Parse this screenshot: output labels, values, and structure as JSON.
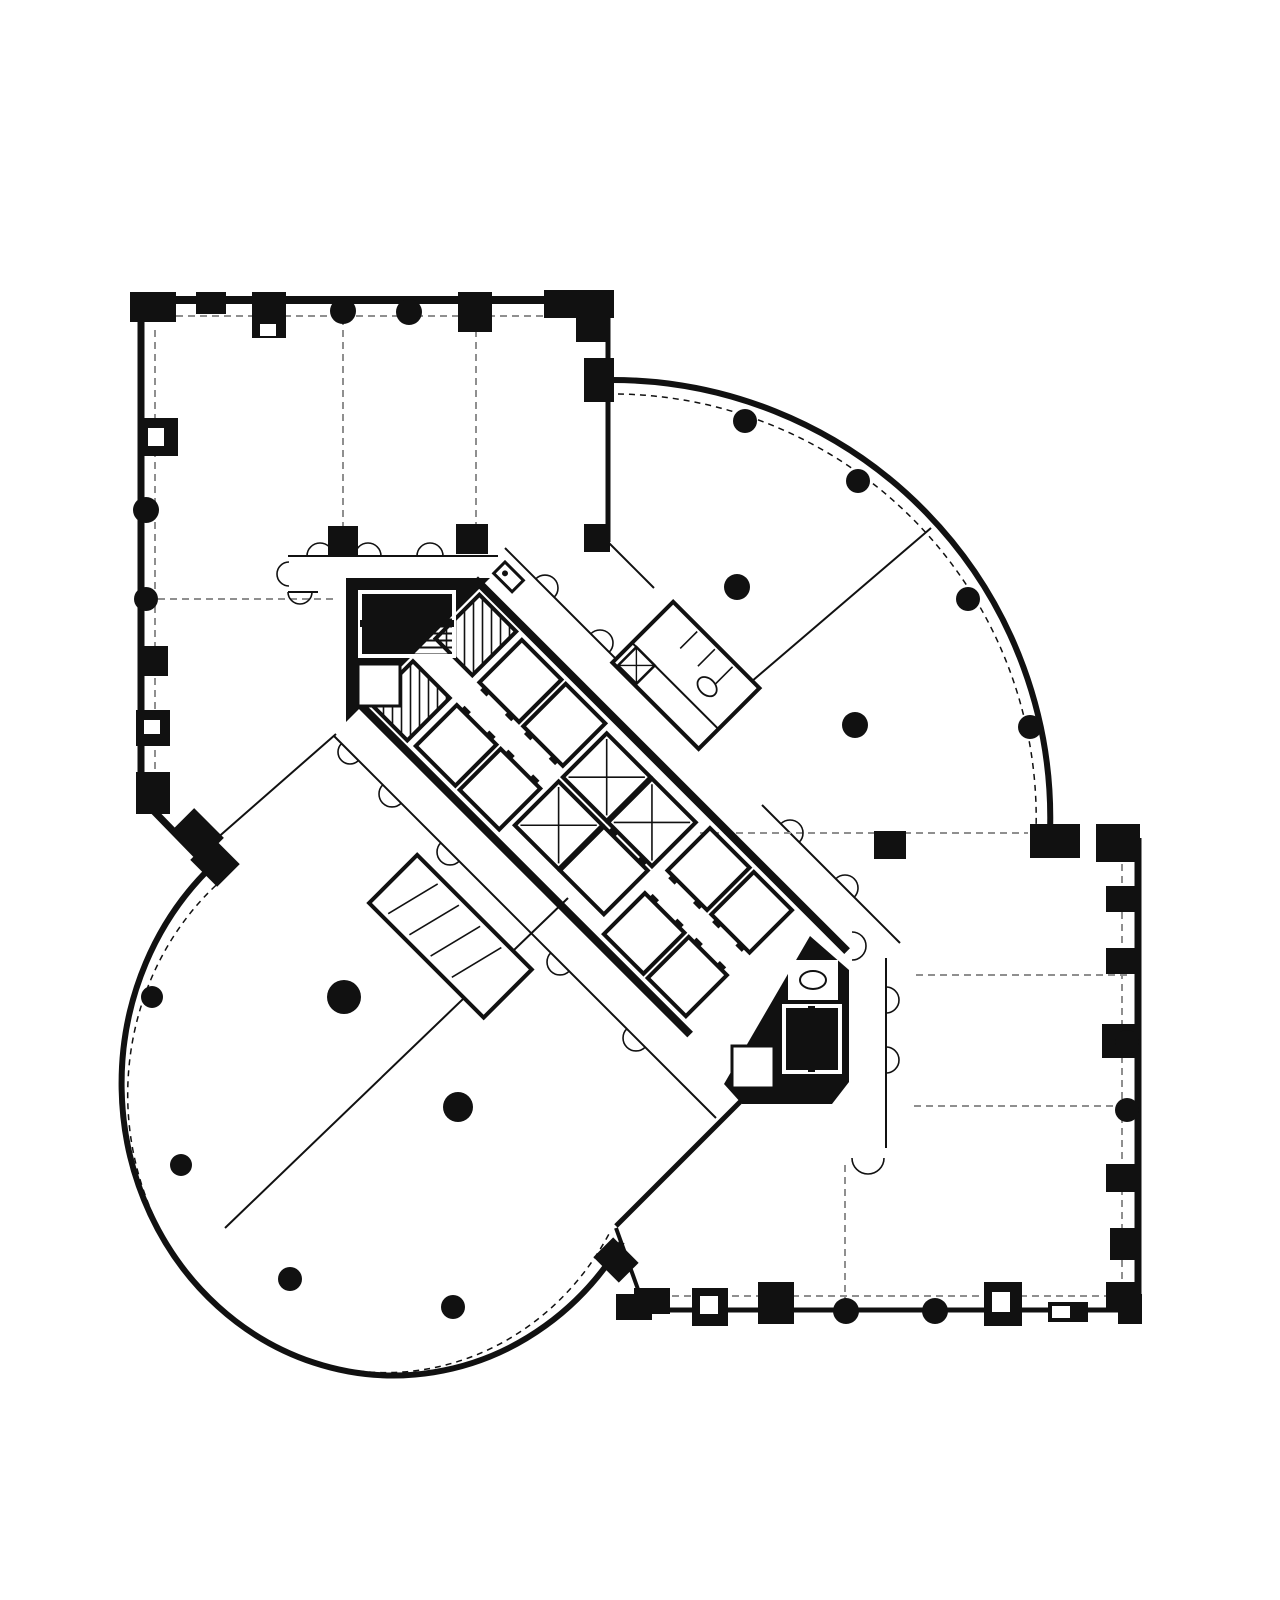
{
  "document": {
    "kind": "scanned architectural floor plan, typical tower floor",
    "visible_text": [],
    "colors": {
      "paper": "#ffffff",
      "ink": "#111111",
      "faint": "#8f8f8f"
    }
  },
  "plan": {
    "regions": [
      "wing-top-left-rectangular",
      "wing-top-right-quarter-round",
      "wing-bottom-left-circular",
      "wing-bottom-right-rectangular",
      "central-diagonal-core"
    ],
    "columns_round": [
      [
        343,
        311,
        13
      ],
      [
        409,
        312,
        13
      ],
      [
        146,
        510,
        13
      ],
      [
        146,
        599,
        12
      ],
      [
        745,
        421,
        12
      ],
      [
        858,
        481,
        12
      ],
      [
        968,
        599,
        12
      ],
      [
        1030,
        727,
        12
      ],
      [
        737,
        587,
        13
      ],
      [
        855,
        725,
        13
      ],
      [
        152,
        997,
        11
      ],
      [
        181,
        1165,
        11
      ],
      [
        290,
        1279,
        12
      ],
      [
        453,
        1307,
        12
      ],
      [
        344,
        997,
        17
      ],
      [
        458,
        1107,
        15
      ],
      [
        1127,
        1042,
        12
      ],
      [
        1127,
        1110,
        12
      ],
      [
        846,
        1311,
        13
      ],
      [
        935,
        1311,
        13
      ]
    ],
    "piers": [
      [
        130,
        292,
        46,
        30,
        0
      ],
      [
        196,
        292,
        30,
        22,
        0
      ],
      [
        252,
        292,
        34,
        46,
        0
      ],
      [
        458,
        292,
        34,
        40,
        0
      ],
      [
        544,
        290,
        70,
        28,
        0
      ],
      [
        576,
        316,
        30,
        26,
        0
      ],
      [
        584,
        358,
        30,
        44,
        0
      ],
      [
        138,
        418,
        40,
        38,
        0
      ],
      [
        138,
        646,
        30,
        30,
        0
      ],
      [
        136,
        710,
        34,
        36,
        0
      ],
      [
        136,
        772,
        34,
        42,
        0
      ],
      [
        176,
        818,
        42,
        34,
        45
      ],
      [
        196,
        846,
        38,
        32,
        45
      ],
      [
        328,
        526,
        30,
        30,
        0
      ],
      [
        456,
        524,
        32,
        30,
        0
      ],
      [
        584,
        524,
        26,
        28,
        0
      ],
      [
        874,
        831,
        32,
        28,
        0
      ],
      [
        1030,
        824,
        50,
        34,
        0
      ],
      [
        1096,
        824,
        44,
        38,
        0
      ],
      [
        1106,
        886,
        32,
        26,
        0
      ],
      [
        1106,
        948,
        32,
        26,
        0
      ],
      [
        1102,
        1024,
        38,
        34,
        0
      ],
      [
        1106,
        1164,
        32,
        28,
        0
      ],
      [
        1110,
        1228,
        30,
        32,
        0
      ],
      [
        1106,
        1282,
        34,
        28,
        0
      ],
      [
        634,
        1288,
        36,
        26,
        0
      ],
      [
        692,
        1288,
        36,
        38,
        0
      ],
      [
        758,
        1282,
        36,
        42,
        0
      ],
      [
        984,
        1282,
        38,
        44,
        0
      ],
      [
        1048,
        1302,
        40,
        20,
        0
      ],
      [
        1118,
        1294,
        24,
        30,
        0
      ],
      [
        598,
        1246,
        36,
        28,
        45
      ],
      [
        616,
        1294,
        36,
        26,
        0
      ]
    ],
    "notches": [
      [
        260,
        324,
        16,
        12
      ],
      [
        148,
        428,
        16,
        18
      ],
      [
        144,
        720,
        16,
        14
      ],
      [
        700,
        1296,
        18,
        18
      ],
      [
        992,
        1292,
        18,
        20
      ],
      [
        1052,
        1306,
        18,
        12
      ]
    ],
    "dashed_partitions": [
      [
        343,
        318,
        343,
        552
      ],
      [
        476,
        318,
        476,
        524
      ],
      [
        158,
        599,
        334,
        599
      ],
      [
        700,
        833,
        1028,
        833
      ],
      [
        916,
        975,
        1128,
        975
      ],
      [
        914,
        1106,
        1128,
        1106
      ],
      [
        845,
        1165,
        845,
        1306
      ],
      [
        152,
        316,
        598,
        316
      ],
      [
        155,
        330,
        155,
        788
      ],
      [
        1122,
        852,
        1122,
        1290
      ],
      [
        660,
        1296,
        1114,
        1296
      ]
    ],
    "thin_partitions": [
      [
        207,
        847,
        336,
        734,
        2
      ],
      [
        568,
        898,
        225,
        1228,
        2
      ],
      [
        931,
        528,
        744,
        688,
        2
      ],
      [
        505,
        548,
        688,
        731,
        2
      ],
      [
        762,
        805,
        900,
        943,
        2
      ],
      [
        334,
        736,
        716,
        1118,
        2
      ],
      [
        886,
        958,
        886,
        1148,
        2
      ],
      [
        288,
        556,
        498,
        556,
        2
      ],
      [
        288,
        592,
        318,
        592,
        2
      ],
      [
        606,
        540,
        654,
        588,
        2
      ],
      [
        616,
        1228,
        644,
        1306,
        4
      ],
      [
        756,
        1086,
        616,
        1226,
        5
      ]
    ],
    "door_arcs": [
      [
        320,
        556,
        13,
        180
      ],
      [
        368,
        556,
        13,
        180
      ],
      [
        430,
        556,
        13,
        180
      ],
      [
        300,
        592,
        12,
        0
      ],
      [
        289,
        574,
        12,
        90
      ],
      [
        545,
        588,
        13,
        225
      ],
      [
        600,
        643,
        13,
        225
      ],
      [
        655,
        698,
        13,
        225
      ],
      [
        790,
        833,
        13,
        225
      ],
      [
        845,
        888,
        13,
        225
      ],
      [
        392,
        794,
        13,
        45
      ],
      [
        450,
        852,
        13,
        45
      ],
      [
        560,
        962,
        13,
        45
      ],
      [
        636,
        1038,
        13,
        45
      ],
      [
        350,
        752,
        12,
        45
      ],
      [
        886,
        1000,
        13,
        270
      ],
      [
        886,
        1060,
        13,
        270
      ],
      [
        868,
        1158,
        16,
        0
      ],
      [
        852,
        946,
        14,
        270
      ]
    ],
    "core": {
      "band_origin": [
        478,
        582
      ],
      "band_angle_deg": 45,
      "band_length": 520,
      "band_width": 170,
      "cells": [
        [
          10,
          8,
          52,
          62,
          "duct"
        ],
        [
          10,
          102,
          52,
          60,
          "duct"
        ],
        [
          72,
          10,
          56,
          60,
          "plain"
        ],
        [
          134,
          10,
          56,
          60,
          "plain"
        ],
        [
          338,
          10,
          56,
          60,
          "plain"
        ],
        [
          400,
          10,
          54,
          60,
          "plain"
        ],
        [
          72,
          102,
          56,
          58,
          "plain"
        ],
        [
          134,
          102,
          56,
          58,
          "plain"
        ],
        [
          338,
          102,
          56,
          58,
          "plain"
        ],
        [
          400,
          102,
          54,
          58,
          "plain"
        ],
        [
          198,
          16,
          62,
          62,
          "x"
        ],
        [
          262,
          16,
          62,
          62,
          "x"
        ],
        [
          198,
          84,
          62,
          62,
          "x"
        ],
        [
          262,
          84,
          62,
          62,
          "plain"
        ]
      ],
      "restroom_ne": {
        "rect": [
          152,
          -124,
          122,
          86
        ],
        "stalls_x": [
          190,
          215,
          240
        ],
        "xbox": [
          158,
          -66,
          26,
          26
        ],
        "basin": [
          236,
          -88,
          11,
          8
        ]
      },
      "restroom_sw": {
        "rect": [
          150,
          236,
          162,
          68
        ],
        "stalls_x": [
          185,
          215,
          245,
          275
        ]
      },
      "stair_top": {
        "well": [
          360,
          592,
          94,
          64
        ],
        "divider": [
          360,
          620,
          94,
          7
        ],
        "closet": [
          358,
          664,
          42,
          42
        ]
      },
      "stair_bottom": {
        "well": [
          784,
          1006,
          56,
          66
        ],
        "divider": [
          808,
          1006,
          7,
          66
        ],
        "closet": [
          732,
          1046,
          42,
          42
        ],
        "wc": [
          788,
          960,
          50,
          40
        ]
      }
    }
  }
}
